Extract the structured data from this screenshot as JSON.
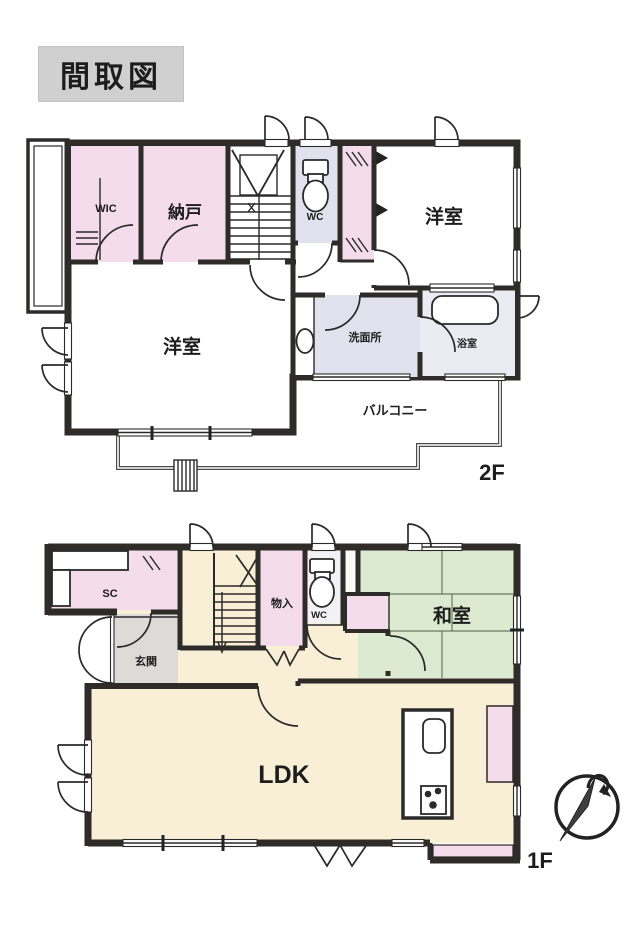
{
  "title": "間取図",
  "floor2": {
    "floor_label": "2F",
    "rooms": {
      "wic": "WIC",
      "nando": "納戸",
      "wc": "WC",
      "yoshitsu_upper": "洋室",
      "yoshitsu_lower": "洋室",
      "senmenjo": "洗面所",
      "yokushitsu": "浴室",
      "balcony": "バルコニー"
    }
  },
  "floor1": {
    "floor_label": "1F",
    "rooms": {
      "sc": "SC",
      "genkan": "玄関",
      "monoire": "物入",
      "wc": "WC",
      "washitsu": "和室",
      "ldk": "LDK"
    }
  },
  "colors": {
    "wall": "#2e2b28",
    "room_pink": "#f4dcec",
    "room_beige": "#f9eed6",
    "room_lavender": "#e2e2ee",
    "room_bath": "#ebebf3",
    "room_tatami_green": "#dcead2",
    "room_genkan_gray": "#dcdbd8",
    "title_bg": "#d0d0d0"
  }
}
